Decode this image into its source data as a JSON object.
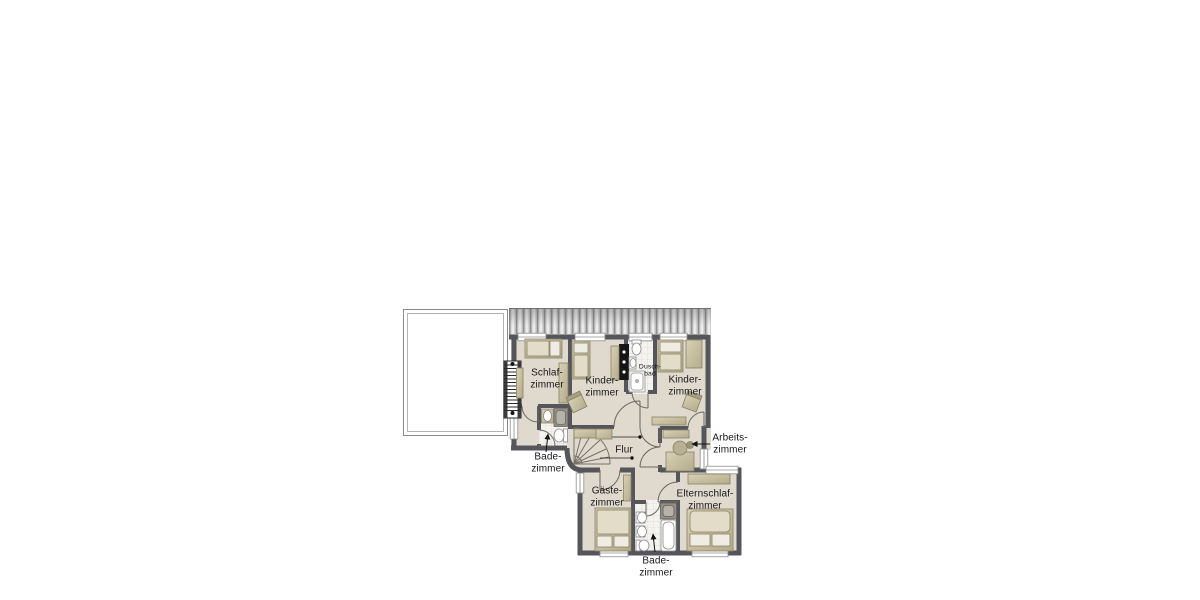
{
  "rooms": [
    {
      "id": "schlafzimmer",
      "label": "Schlaf-\nzimmer"
    },
    {
      "id": "kinderzimmer-links",
      "label": "Kinder-\nzimmer"
    },
    {
      "id": "duschbad",
      "label": "Dusch-\nbad"
    },
    {
      "id": "kinderzimmer-rechts",
      "label": "Kinder-\nzimmer"
    },
    {
      "id": "badezimmer-oben",
      "label": "Bade-\nzimmer"
    },
    {
      "id": "flur",
      "label": "Flur"
    },
    {
      "id": "arbeitszimmer",
      "label": "Arbeits-\nzimmer"
    },
    {
      "id": "gaestezimmer",
      "label": "Gäste-\nzimmer"
    },
    {
      "id": "elternschlafzimmer",
      "label": "Elternschlaf-\nzimmer"
    },
    {
      "id": "badezimmer-unten",
      "label": "Bade-\nzimmer"
    }
  ],
  "colors": {
    "background": "#ffffff",
    "floor": "#dfdacd",
    "wall": "#55555c",
    "bath_tile": "#f4f3ef",
    "tile_line": "#dcdad2",
    "furniture": "#c9c0a2",
    "furniture_light": "#e9e4d4",
    "pillow": "#efece4",
    "shower_dark": "#928e86",
    "roof_stripe": "#c9c9c9",
    "terrace_border": "#8a8a8a",
    "chimney": "#161616",
    "text": "#17171a"
  }
}
